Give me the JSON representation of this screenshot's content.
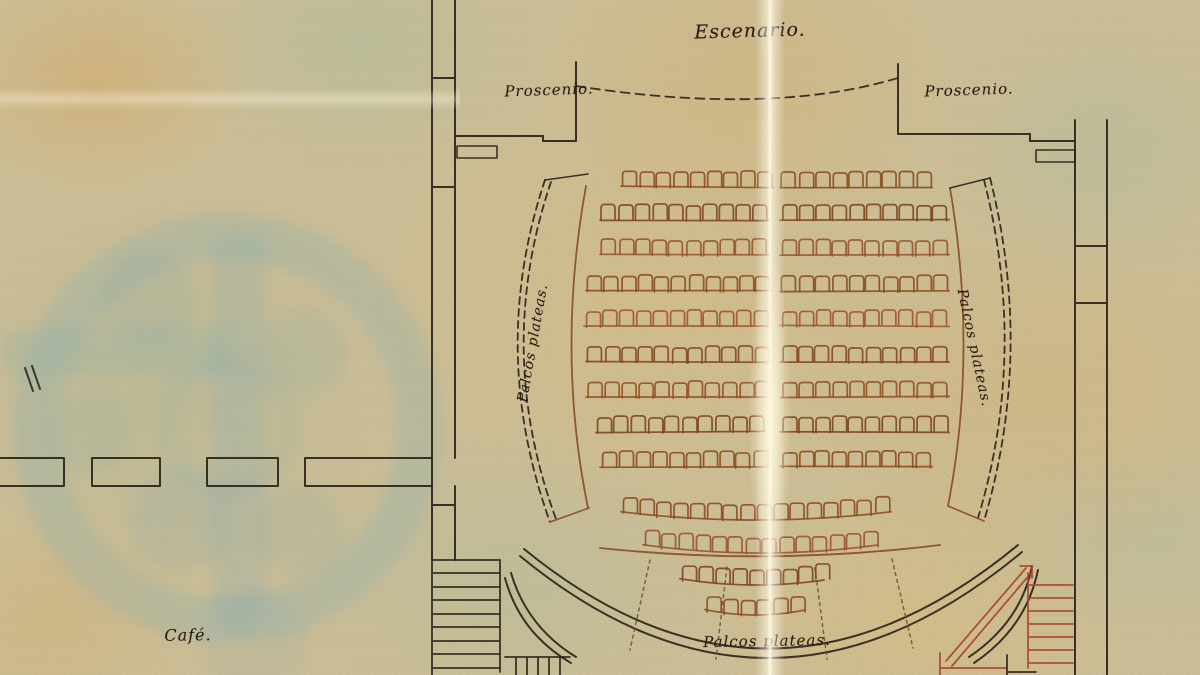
{
  "labels": {
    "stage": "Escenario.",
    "proscenium_left": "Proscenio.",
    "proscenium_right": "Proscenio.",
    "boxes_left": "Palcos plateas.",
    "boxes_right": "Palcos plateas.",
    "boxes_rear": "Palcos plateas.",
    "cafe": "Café."
  },
  "colors": {
    "paper": "#ccbe96",
    "ink": "#2a2118",
    "seat_brown": "#8a4a1d",
    "gallery_red": "#8a4a22",
    "stair_red": "#a8442b",
    "stain_blue": "#7fa9b0",
    "crease": "#fff8e4"
  },
  "seating": {
    "seat_width": 14,
    "seat_height": 15,
    "pitch": 16.8,
    "straight_rows": [
      {
        "y": 172,
        "left_x": 623,
        "left_count": 9,
        "right_x": 782,
        "right_count": 9,
        "color": "#8a4a1d"
      },
      {
        "y": 205,
        "left_x": 602,
        "left_count": 10,
        "right_x": 782,
        "right_count": 10,
        "color": "#7c421a"
      },
      {
        "y": 240,
        "left_x": 602,
        "left_count": 10,
        "right_x": 782,
        "right_count": 10,
        "color": "#95522a"
      },
      {
        "y": 276,
        "left_x": 588,
        "left_count": 11,
        "right_x": 782,
        "right_count": 10,
        "color": "#8a4a1d"
      },
      {
        "y": 311,
        "left_x": 586,
        "left_count": 11,
        "right_x": 782,
        "right_count": 10,
        "color": "#9b5626"
      },
      {
        "y": 347,
        "left_x": 588,
        "left_count": 11,
        "right_x": 782,
        "right_count": 10,
        "color": "#82471e"
      },
      {
        "y": 382,
        "left_x": 588,
        "left_count": 11,
        "right_x": 782,
        "right_count": 10,
        "color": "#8f4e22"
      },
      {
        "y": 417,
        "left_x": 598,
        "left_count": 10,
        "right_x": 782,
        "right_count": 10,
        "color": "#7c421a"
      },
      {
        "y": 452,
        "left_x": 602,
        "left_count": 10,
        "right_x": 782,
        "right_count": 9,
        "color": "#8a4a1d"
      }
    ],
    "curved_rows": [
      {
        "y": 497,
        "x": 623,
        "count": 16,
        "sag": 8,
        "color": "#8a4a1d"
      },
      {
        "y": 530,
        "x": 645,
        "count": 14,
        "sag": 8,
        "color": "#95522a"
      },
      {
        "y": 564,
        "x": 682,
        "count": 9,
        "sag": 6,
        "color": "#7c421a"
      },
      {
        "y": 595,
        "x": 707,
        "count": 6,
        "sag": 5,
        "color": "#8a4a1d"
      }
    ]
  }
}
